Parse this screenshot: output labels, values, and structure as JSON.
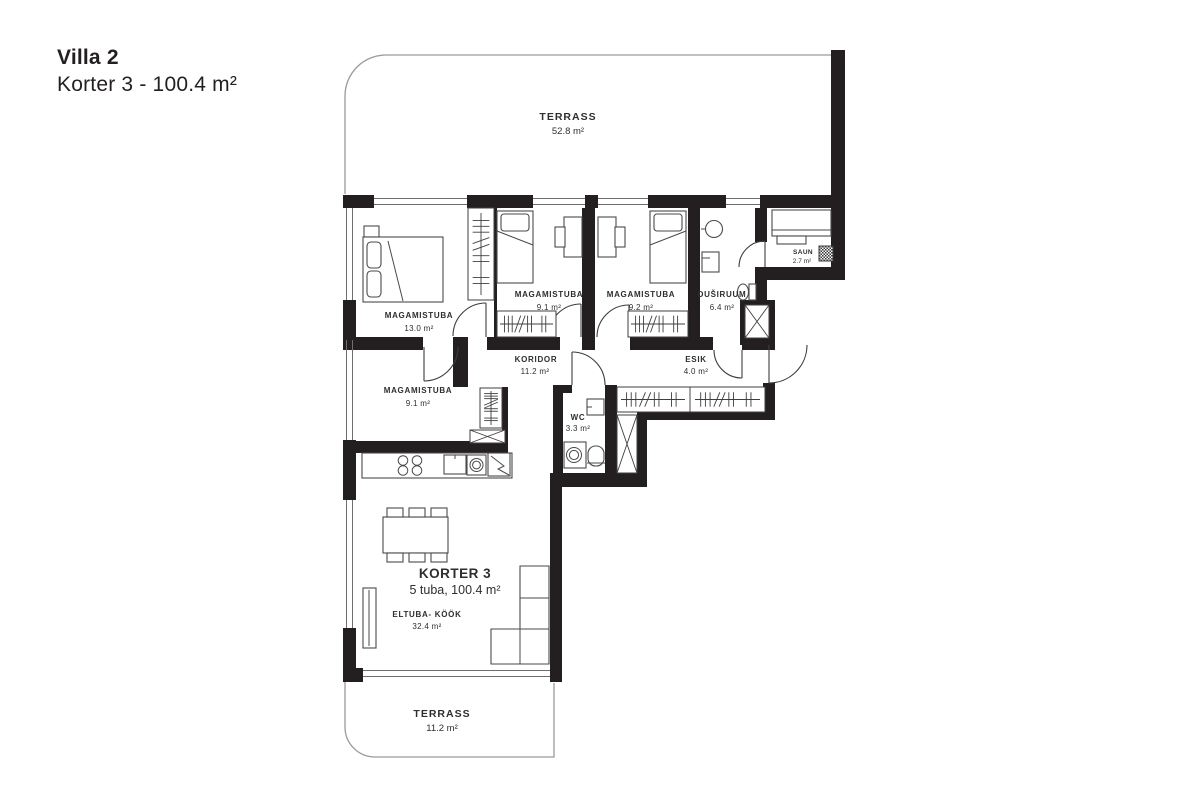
{
  "title": {
    "line1": "Villa 2",
    "line2": "Korter 3 - 100.4 m²"
  },
  "apartment": {
    "name": "KORTER 3",
    "summary": "5 tuba, 100.4 m²"
  },
  "terraces": {
    "top": {
      "name": "TERRASS",
      "area": "52.8 m²"
    },
    "bottom": {
      "name": "TERRASS",
      "area": "11.2 m²"
    }
  },
  "rooms": {
    "magamistuba_13": {
      "name": "MAGAMISTUBA",
      "area": "13.0 m²"
    },
    "magamistuba_91_top": {
      "name": "MAGAMISTUBA",
      "area": "9.1 m²"
    },
    "magamistuba_92": {
      "name": "MAGAMISTUBA",
      "area": "9.2 m²"
    },
    "dusiruum": {
      "name": "DUŠIRUUM",
      "area": "6.4 m²"
    },
    "saun": {
      "name": "SAUN",
      "area": "2.7 m²"
    },
    "koridor": {
      "name": "KORIDOR",
      "area": "11.2 m²"
    },
    "esik": {
      "name": "ESIK",
      "area": "4.0 m²"
    },
    "magamistuba_91_bottom": {
      "name": "MAGAMISTUBA",
      "area": "9.1 m²"
    },
    "wc": {
      "name": "WC",
      "area": "3.3 m²"
    },
    "elutuba_kook": {
      "name": "ELTUBA- KÖÖK",
      "area": "32.4 m²"
    }
  },
  "colors": {
    "wall": "#231f20",
    "text": "#2e2e2e",
    "terrace_outline": "#9a9a9a"
  }
}
